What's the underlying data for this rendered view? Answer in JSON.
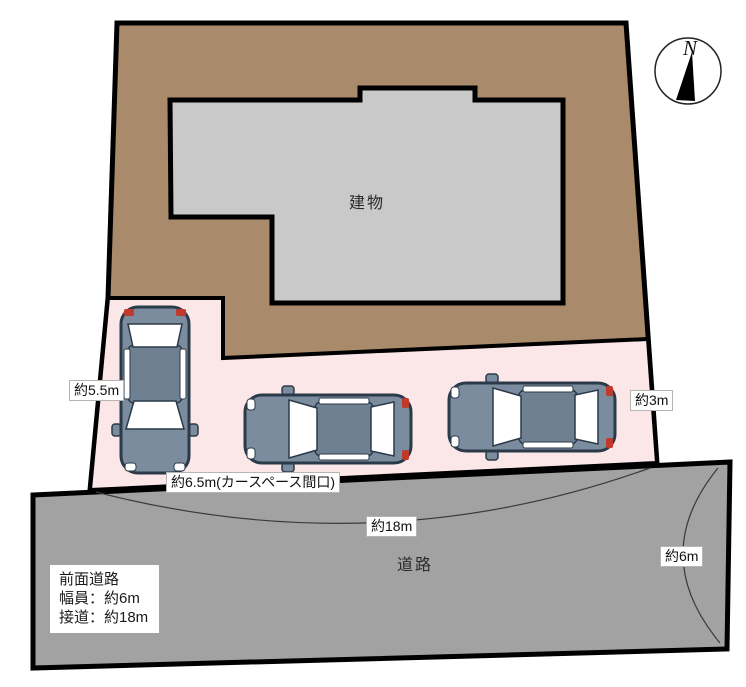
{
  "diagram": {
    "compass": {
      "north_label": "N"
    },
    "areas": {
      "building_label": "建物",
      "road_label": "道路"
    },
    "dimension_labels": {
      "car_space_depth": "約5.5m",
      "car_space_frontage": "約6.5m(カースペース間口)",
      "side_gap": "約3m",
      "road_frontage": "約18m",
      "road_width": "約6m"
    },
    "front_road_info": {
      "title": "前面道路",
      "width_line": "幅員：約6m",
      "frontage_line": "接道：約18m"
    },
    "colors": {
      "lot_fill": "#a98a6b",
      "building_fill": "#c9c9c9",
      "car_space_fill": "#fbe7e7",
      "road_fill": "#a2a2a2",
      "outline": "#000000",
      "car_body": "#7b8c9e",
      "car_roof": "#6e8092",
      "car_outline": "#2b3a49",
      "car_window": "#ffffff",
      "taillight": "#c0392b"
    }
  }
}
